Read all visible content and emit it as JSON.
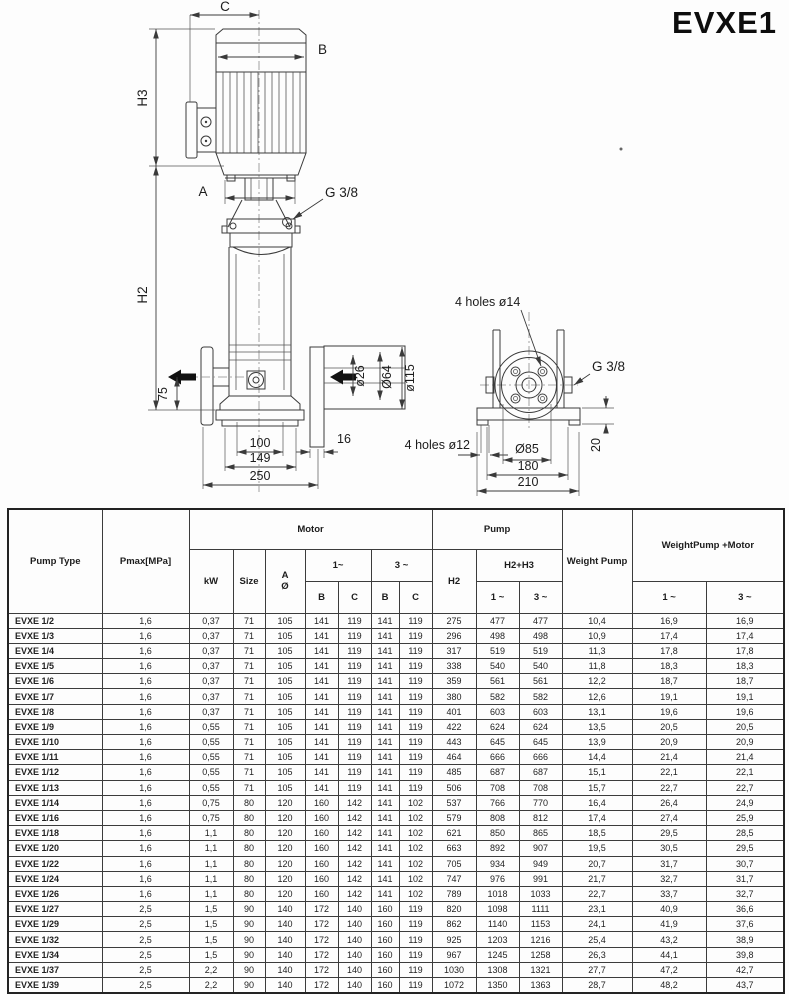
{
  "title": "EVXE1",
  "drawing": {
    "front": {
      "dim_c": "C",
      "dim_b": "B",
      "dim_h3": "H3",
      "dim_a": "A",
      "port_thread": "G 3/8",
      "dim_h2": "H2",
      "dim_75": "75",
      "dim_d26": "ø26",
      "dim_d64": "Ø64",
      "dim_d115": "ø115",
      "dim_16": "16",
      "dim_100": "100",
      "dim_149": "149",
      "dim_250": "250"
    },
    "side": {
      "holes_top": "4 holes ø14",
      "port_thread": "G 3/8",
      "holes_bottom": "4 holes ø12",
      "dim_d85": "Ø85",
      "dim_180": "180",
      "dim_210": "210",
      "dim_20": "20"
    }
  },
  "table": {
    "headers": {
      "pump_type": "Pump Type",
      "pmax": "Pmax[MPa]",
      "motor": "Motor",
      "kw": "kW",
      "size": "Size",
      "a": "A",
      "dia": "Ø",
      "one_phase": "1~",
      "three_phase": "3 ~",
      "b": "B",
      "c": "C",
      "h2": "H2",
      "pump": "Pump",
      "h2h3": "H2+H3",
      "one_tilde": "1 ~",
      "three_tilde": "3 ~",
      "weight_pump": "Weight Pump",
      "weight_pump_motor": "WeightPump +Motor"
    },
    "rows": [
      [
        "EVXE 1/2",
        "1,6",
        "0,37",
        "71",
        "105",
        "141",
        "119",
        "141",
        "119",
        "275",
        "477",
        "477",
        "10,4",
        "16,9",
        "16,9"
      ],
      [
        "EVXE 1/3",
        "1,6",
        "0,37",
        "71",
        "105",
        "141",
        "119",
        "141",
        "119",
        "296",
        "498",
        "498",
        "10,9",
        "17,4",
        "17,4"
      ],
      [
        "EVXE 1/4",
        "1,6",
        "0,37",
        "71",
        "105",
        "141",
        "119",
        "141",
        "119",
        "317",
        "519",
        "519",
        "11,3",
        "17,8",
        "17,8"
      ],
      [
        "EVXE 1/5",
        "1,6",
        "0,37",
        "71",
        "105",
        "141",
        "119",
        "141",
        "119",
        "338",
        "540",
        "540",
        "11,8",
        "18,3",
        "18,3"
      ],
      [
        "EVXE 1/6",
        "1,6",
        "0,37",
        "71",
        "105",
        "141",
        "119",
        "141",
        "119",
        "359",
        "561",
        "561",
        "12,2",
        "18,7",
        "18,7"
      ],
      [
        "EVXE 1/7",
        "1,6",
        "0,37",
        "71",
        "105",
        "141",
        "119",
        "141",
        "119",
        "380",
        "582",
        "582",
        "12,6",
        "19,1",
        "19,1"
      ],
      [
        "EVXE 1/8",
        "1,6",
        "0,37",
        "71",
        "105",
        "141",
        "119",
        "141",
        "119",
        "401",
        "603",
        "603",
        "13,1",
        "19,6",
        "19,6"
      ],
      [
        "EVXE 1/9",
        "1,6",
        "0,55",
        "71",
        "105",
        "141",
        "119",
        "141",
        "119",
        "422",
        "624",
        "624",
        "13,5",
        "20,5",
        "20,5"
      ],
      [
        "EVXE 1/10",
        "1,6",
        "0,55",
        "71",
        "105",
        "141",
        "119",
        "141",
        "119",
        "443",
        "645",
        "645",
        "13,9",
        "20,9",
        "20,9"
      ],
      [
        "EVXE 1/11",
        "1,6",
        "0,55",
        "71",
        "105",
        "141",
        "119",
        "141",
        "119",
        "464",
        "666",
        "666",
        "14,4",
        "21,4",
        "21,4"
      ],
      [
        "EVXE 1/12",
        "1,6",
        "0,55",
        "71",
        "105",
        "141",
        "119",
        "141",
        "119",
        "485",
        "687",
        "687",
        "15,1",
        "22,1",
        "22,1"
      ],
      [
        "EVXE 1/13",
        "1,6",
        "0,55",
        "71",
        "105",
        "141",
        "119",
        "141",
        "119",
        "506",
        "708",
        "708",
        "15,7",
        "22,7",
        "22,7"
      ],
      [
        "EVXE 1/14",
        "1,6",
        "0,75",
        "80",
        "120",
        "160",
        "142",
        "141",
        "102",
        "537",
        "766",
        "770",
        "16,4",
        "26,4",
        "24,9"
      ],
      [
        "EVXE 1/16",
        "1,6",
        "0,75",
        "80",
        "120",
        "160",
        "142",
        "141",
        "102",
        "579",
        "808",
        "812",
        "17,4",
        "27,4",
        "25,9"
      ],
      [
        "EVXE 1/18",
        "1,6",
        "1,1",
        "80",
        "120",
        "160",
        "142",
        "141",
        "102",
        "621",
        "850",
        "865",
        "18,5",
        "29,5",
        "28,5"
      ],
      [
        "EVXE 1/20",
        "1,6",
        "1,1",
        "80",
        "120",
        "160",
        "142",
        "141",
        "102",
        "663",
        "892",
        "907",
        "19,5",
        "30,5",
        "29,5"
      ],
      [
        "EVXE 1/22",
        "1,6",
        "1,1",
        "80",
        "120",
        "160",
        "142",
        "141",
        "102",
        "705",
        "934",
        "949",
        "20,7",
        "31,7",
        "30,7"
      ],
      [
        "EVXE 1/24",
        "1,6",
        "1,1",
        "80",
        "120",
        "160",
        "142",
        "141",
        "102",
        "747",
        "976",
        "991",
        "21,7",
        "32,7",
        "31,7"
      ],
      [
        "EVXE 1/26",
        "1,6",
        "1,1",
        "80",
        "120",
        "160",
        "142",
        "141",
        "102",
        "789",
        "1018",
        "1033",
        "22,7",
        "33,7",
        "32,7"
      ],
      [
        "EVXE 1/27",
        "2,5",
        "1,5",
        "90",
        "140",
        "172",
        "140",
        "160",
        "119",
        "820",
        "1098",
        "1111",
        "23,1",
        "40,9",
        "36,6"
      ],
      [
        "EVXE 1/29",
        "2,5",
        "1,5",
        "90",
        "140",
        "172",
        "140",
        "160",
        "119",
        "862",
        "1140",
        "1153",
        "24,1",
        "41,9",
        "37,6"
      ],
      [
        "EVXE 1/32",
        "2,5",
        "1,5",
        "90",
        "140",
        "172",
        "140",
        "160",
        "119",
        "925",
        "1203",
        "1216",
        "25,4",
        "43,2",
        "38,9"
      ],
      [
        "EVXE 1/34",
        "2,5",
        "1,5",
        "90",
        "140",
        "172",
        "140",
        "160",
        "119",
        "967",
        "1245",
        "1258",
        "26,3",
        "44,1",
        "39,8"
      ],
      [
        "EVXE 1/37",
        "2,5",
        "2,2",
        "90",
        "140",
        "172",
        "140",
        "160",
        "119",
        "1030",
        "1308",
        "1321",
        "27,7",
        "47,2",
        "42,7"
      ],
      [
        "EVXE 1/39",
        "2,5",
        "2,2",
        "90",
        "140",
        "172",
        "140",
        "160",
        "119",
        "1072",
        "1350",
        "1363",
        "28,7",
        "48,2",
        "43,7"
      ]
    ]
  }
}
